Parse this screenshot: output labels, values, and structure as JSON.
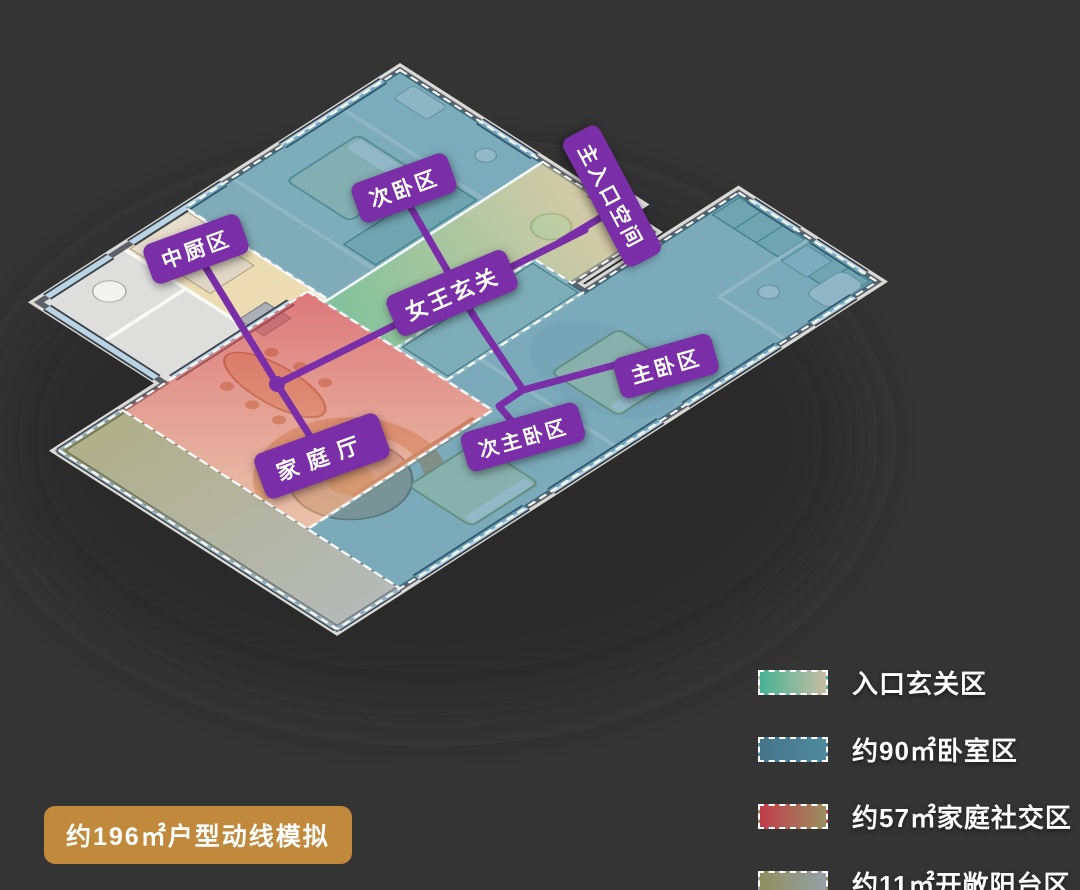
{
  "title": {
    "text": "约196㎡户型动线模拟"
  },
  "colors": {
    "background": "#343434",
    "accent_purple": "#7a2fa8",
    "title_gold": "#c0893c"
  },
  "plan": {
    "labels": [
      {
        "id": "kitchen",
        "text": "中厨区"
      },
      {
        "id": "secondary-bedroom",
        "text": "次卧区"
      },
      {
        "id": "main-entrance",
        "text": "主入口空间"
      },
      {
        "id": "foyer",
        "text": "女王玄关"
      },
      {
        "id": "master-bedroom",
        "text": "主卧区"
      },
      {
        "id": "junior-master-bedroom",
        "text": "次主卧区"
      },
      {
        "id": "family-hall",
        "text": "家庭厅"
      }
    ]
  },
  "legend": {
    "items": [
      {
        "label": "入口玄关区",
        "colors": [
          "#45b393",
          "#c8bda5"
        ]
      },
      {
        "label": "约90㎡卧室区",
        "colors": [
          "#45758a",
          "#4e8a9e"
        ]
      },
      {
        "label": "约57㎡家庭社交区",
        "colors": [
          "#c23c4c",
          "#99905f"
        ]
      },
      {
        "label": "约11㎡开敞阳台区",
        "colors": [
          "#8e8f5d",
          "#97a0a6"
        ]
      }
    ]
  }
}
